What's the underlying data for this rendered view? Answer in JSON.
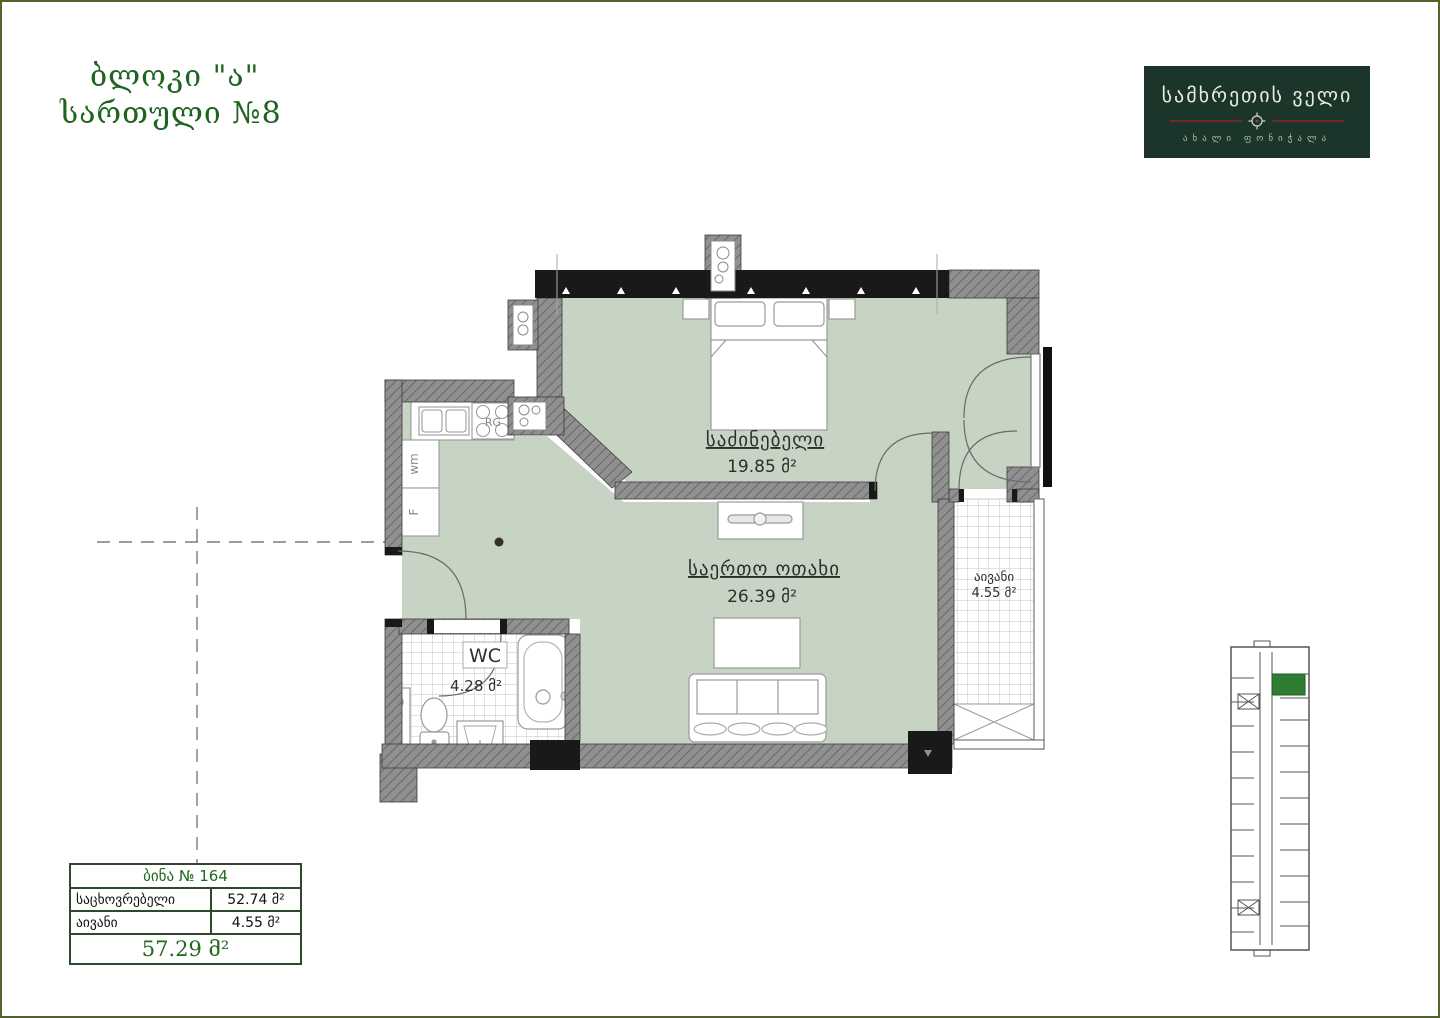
{
  "header": {
    "block": "ბლოკი \"ა\"",
    "floor": "სართული №8"
  },
  "logo": {
    "title": "სამხრეთის ველი",
    "subtitle": "ახალი ფონიჭალა",
    "bg_color": "#1c352a",
    "line_color": "#6d2a22"
  },
  "plan": {
    "bedroom": {
      "name": "საძინებელი",
      "area": "19.85 მ²"
    },
    "living": {
      "name": "საერთო ოთახი",
      "area": "26.39 მ²"
    },
    "balcony": {
      "name": "აივანი",
      "area": "4.55 მ²"
    },
    "wc": {
      "name": "WC",
      "area": "4.28 მ²"
    },
    "kitchen": {
      "stove": "RG",
      "washer": "wm",
      "fridge": "F"
    },
    "floor_color": "#c8d4c3"
  },
  "summary_table": {
    "title": "ბინა № 164",
    "rows": [
      {
        "label": "საცხოვრებელი",
        "value": "52.74 მ²"
      },
      {
        "label": "აივანი",
        "value": "4.55 მ²"
      }
    ],
    "total": "57.29 მ²"
  },
  "key_plan": {
    "highlight_color": "#2e7d32"
  },
  "colors": {
    "accent_green": "#1e6420",
    "wall_gray": "#8e8e8e",
    "wall_black": "#191919"
  }
}
